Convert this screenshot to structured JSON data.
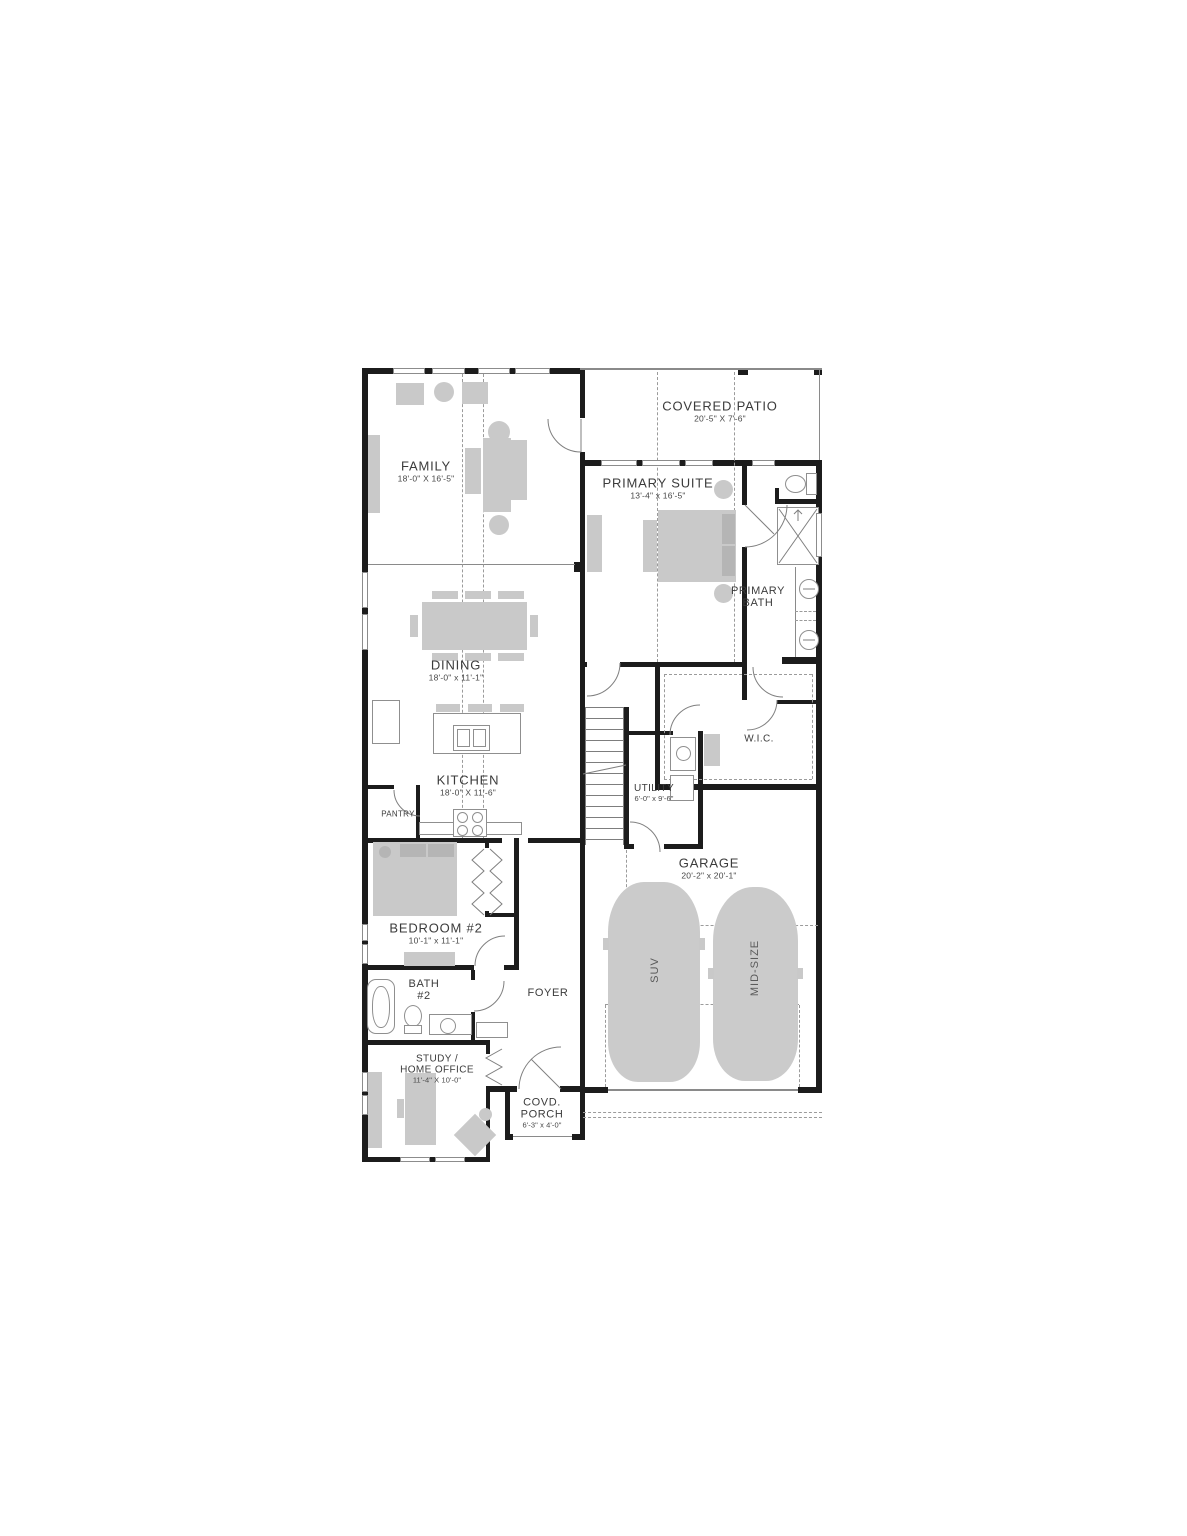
{
  "labels": {
    "family": {
      "name": "FAMILY",
      "dims": "18'-0\" X 16'-5\""
    },
    "patio": {
      "name": "COVERED PATIO",
      "dims": "20'-5\" X 7'-6\""
    },
    "suite": {
      "name": "PRIMARY SUITE",
      "dims": "13'-4\" x 16'-5\""
    },
    "pbath": {
      "line1": "PRIMARY",
      "line2": "BATH"
    },
    "dining": {
      "name": "DINING",
      "dims": "18'-0\" x 11'-1\""
    },
    "kitchen": {
      "name": "KITCHEN",
      "dims": "18'-0\" X 11'-6\""
    },
    "pantry": {
      "name": "PANTRY"
    },
    "utility": {
      "name": "UTILITY",
      "dims": "6'-0\" x 9'-6\""
    },
    "wic": {
      "name": "W.I.C."
    },
    "garage": {
      "name": "GARAGE",
      "dims": "20'-2\" x 20'-1\""
    },
    "bedroom2": {
      "name": "BEDROOM #2",
      "dims": "10'-1\" x 11'-1\""
    },
    "bath2": {
      "line1": "BATH",
      "line2": "#2"
    },
    "foyer": {
      "name": "FOYER"
    },
    "study": {
      "line1": "STUDY /",
      "line2": "HOME OFFICE",
      "dims": "11'-4\" X 10'-0\""
    },
    "porch": {
      "line1": "COVD.",
      "line2": "PORCH",
      "dims": "6'-3\" x 4'-0\""
    },
    "cars": {
      "suv": "SUV",
      "midsize": "MID-SIZE"
    }
  },
  "colors": {
    "wall": "#1c1c1c",
    "furniture": "#c9c9c9",
    "dashed_line": "#9b9b9b",
    "label_text": "#3b3b3b"
  }
}
